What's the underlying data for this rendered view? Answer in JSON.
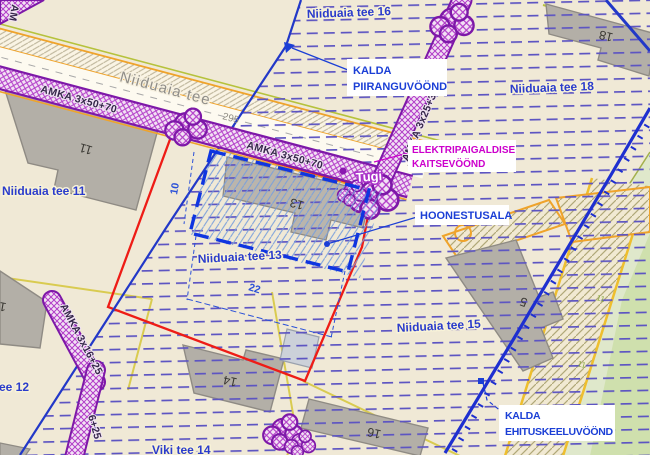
{
  "map": {
    "streets": {
      "main_road": "Niiduaia tee",
      "road_point": "295"
    },
    "parcels": {
      "tee16": "Niiduaia tee 16",
      "tee18": "Niiduaia tee 18",
      "tee11": "Niiduaia tee 11",
      "tee13": "Niiduaia tee 13",
      "tee15": "Niiduaia tee 15",
      "tee12": "ee 12",
      "viki14": "Viki tee 14"
    },
    "buildings": {
      "b11": "11",
      "b12": "12",
      "b13": "13",
      "b14": "14",
      "b16": "16",
      "b18": "18",
      "b5": "5"
    },
    "cables": {
      "amka50_a": "AMKA 3x50+70",
      "amka50_b": "AMKA 3x50+70",
      "amka25": "AMKA 3x25+35",
      "amka16": "AMKA 3x16+25",
      "amka16_partial": "6+25",
      "amka_clip": "AM",
      "support": "Tugi"
    },
    "dimensions": {
      "depth": "10",
      "width": "22"
    },
    "annotations": {
      "kalda_piiranguvoond": {
        "line1": "KALDA",
        "line2": "PIIRANGUVÖÖND"
      },
      "elektripaigaldise": {
        "line1": "ELEKTRIPAIGALDISE",
        "line2": "KAITSEVÖÖND"
      },
      "hoonestusala": {
        "line1": "HOONESTUSALA"
      },
      "kalda_ehituskeeluvoond": {
        "line1": "KALDA",
        "line2": "EHITUSKEELUVÖÖND"
      }
    },
    "elevation_marks": {
      "m1": "11",
      "m2": "11",
      "m3": "11"
    },
    "colors": {
      "background": "#f0e9d6",
      "restriction_dash": "#5d55c2",
      "boundary_blue": "#2238c8",
      "plan_red": "#ee1c16",
      "cable_purple": "#7d18a8",
      "annotation_blue": "#1b3fd6",
      "annotation_magenta": "#cc00cc",
      "road_orange": "#efa32b",
      "parcel_yellow": "#d9cb50",
      "green_area": "#dfe8cb",
      "building_gray": "#b3afa7"
    }
  }
}
